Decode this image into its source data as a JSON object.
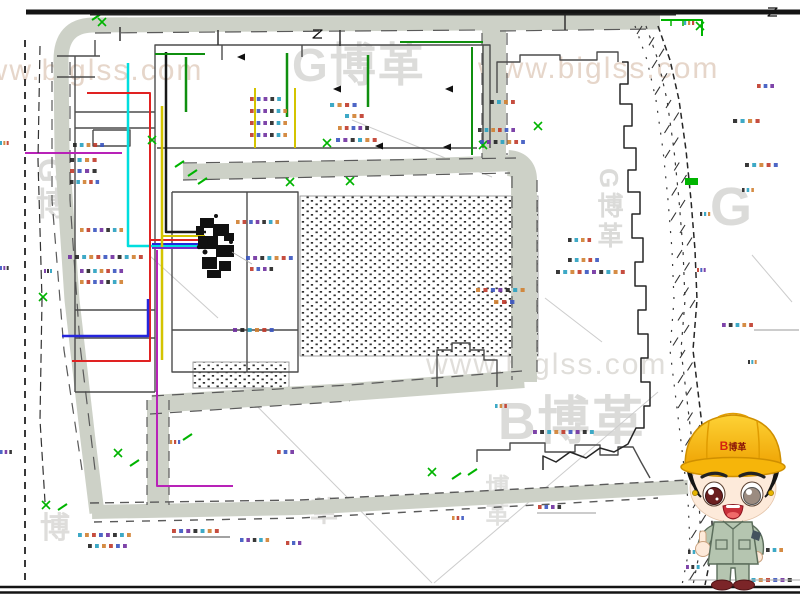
{
  "watermarks": [
    {
      "text": "www.biglss.com",
      "x": -38,
      "y": 56,
      "size": 30,
      "color": "#e6d6ca",
      "bold": false,
      "vertical": false
    },
    {
      "text": "G博革",
      "x": 292,
      "y": 42,
      "size": 46,
      "color": "#dcdcda",
      "bold": true,
      "vertical": false
    },
    {
      "text": "www.biglss.com",
      "x": 478,
      "y": 54,
      "size": 30,
      "color": "#e6d6ca",
      "bold": false,
      "vertical": false
    },
    {
      "text": "G博",
      "x": 34,
      "y": 158,
      "size": 32,
      "color": "#dbdbd9",
      "bold": true,
      "vertical": true
    },
    {
      "text": "G博革",
      "x": 596,
      "y": 168,
      "size": 26,
      "color": "#dbdbd9",
      "bold": true,
      "vertical": true
    },
    {
      "text": "G",
      "x": 710,
      "y": 180,
      "size": 54,
      "color": "#dbdbd9",
      "bold": true,
      "vertical": false
    },
    {
      "text": "www.biglss.com",
      "x": 426,
      "y": 350,
      "size": 30,
      "color": "#e0deda",
      "bold": false,
      "vertical": false
    },
    {
      "text": "B博革",
      "x": 498,
      "y": 396,
      "size": 52,
      "color": "#dbdbd9",
      "bold": true,
      "vertical": false
    },
    {
      "text": "博",
      "x": 40,
      "y": 514,
      "size": 30,
      "color": "#dedddb",
      "bold": true,
      "vertical": false
    },
    {
      "text": "革",
      "x": 310,
      "y": 498,
      "size": 28,
      "color": "#dedddb",
      "bold": true,
      "vertical": false
    },
    {
      "text": "博革",
      "x": 482,
      "y": 474,
      "size": 24,
      "color": "#e0e0de",
      "bold": true,
      "vertical": true
    }
  ],
  "mascot": {
    "hat_logo_b": "B",
    "hat_logo_text": "博革"
  },
  "colors": {
    "road": "#cdd1c7",
    "outline": "#4c4c4c",
    "boundary": "#262626",
    "green": "#00b400",
    "darkgreen": "#0f8f0f",
    "cyan": "#00dede",
    "red": "#e02222",
    "blue": "#2525dd",
    "yellow": "#d4c400",
    "magenta": "#b822b8",
    "purple": "#7828c8",
    "black": "#181818",
    "hatch_dot": "#2f2f2f",
    "annotation_palette": [
      "#3a55c0",
      "#c03a2a",
      "#d08030",
      "#28a0c0",
      "#222222",
      "#7030a0"
    ]
  },
  "diagram": {
    "frame": [
      {
        "d": "M 26,12 L 800,12",
        "w": 5,
        "c": "#141414"
      },
      {
        "d": "M 90,14.5 L 676,14.5",
        "w": 2,
        "c": "#222222"
      },
      {
        "d": "M 0,587 L 800,587",
        "w": 2.4,
        "c": "#141414"
      },
      {
        "d": "M 0,592.5 L 800,592.5",
        "w": 2.4,
        "c": "#141414"
      },
      {
        "d": "M 25,40 L 25,582",
        "w": 1.8,
        "c": "#222222",
        "dash": "7 6"
      },
      {
        "d": "M 40,46 L 38,160 L 42,300 L 40,420 L 45,502",
        "w": 1.2,
        "c": "#333333",
        "dash": "9 5"
      }
    ],
    "roads": [
      {
        "d": "M 97,513 L 88,440 L 72,300 L 62,150 L 61,60 Q 61,26 92,25 L 660,22",
        "w": 15
      },
      {
        "d": "M 92,512 L 300,508 L 500,497 L 688,487",
        "w": 14
      },
      {
        "d": "M 494,29 L 494,160",
        "w": 24
      },
      {
        "d": "M 183,172 L 400,167 L 516,163",
        "w": 16
      },
      {
        "d": "M 508,163 Q 524,164 524,180 L 524,382",
        "w": 26
      },
      {
        "d": "M 152,404 L 350,392 L 524,379",
        "w": 18
      },
      {
        "d": "M 158,400 L 158,506",
        "w": 22
      }
    ],
    "road_edges": [
      {
        "d": "M 95,33 L 480,30",
        "dash": "16 10"
      },
      {
        "d": "M 500,31 L 655,29",
        "dash": "16 10"
      },
      {
        "d": "M 52,62 L 52,200 L 64,350 L 82,470",
        "dash": "11 8"
      },
      {
        "d": "M 70,62 L 70,200 L 80,345 L 96,478",
        "dash": "13 9"
      },
      {
        "d": "M 90,503 L 300,500 L 500,490 L 688,480",
        "dash": "9 6",
        "w": 1.4
      },
      {
        "d": "M 94,522 L 300,518 L 500,507 L 658,498",
        "dash": "8 8",
        "w": 1.4
      },
      {
        "d": "M 183,163 L 516,158",
        "dash": "14 9"
      },
      {
        "d": "M 183,180 L 510,173",
        "dash": "14 9"
      },
      {
        "d": "M 512,176 L 512,380",
        "dash": "12 8"
      },
      {
        "d": "M 537,180 L 537,378",
        "dash": "12 8"
      },
      {
        "d": "M 152,396 L 350,385 L 522,371",
        "dash": "12 8"
      },
      {
        "d": "M 150,414 L 350,401",
        "dash": "12 8"
      },
      {
        "d": "M 482,33 L 482,158",
        "dash": "12 8"
      },
      {
        "d": "M 507,33 L 507,155",
        "dash": "12 8"
      },
      {
        "d": "M 147,400 L 147,505",
        "dash": "10 7"
      },
      {
        "d": "M 169,400 L 169,505",
        "dash": "10 7"
      }
    ],
    "outlines": [
      "M 155,148 L 155,45 L 490,45 L 490,148",
      "M 157,148 L 477,148",
      "M 483,45 L 483,148",
      "M 222,45 L 222,60",
      "M 302,45 L 302,57",
      "M 57,56 L 100,56",
      "M 57,77 L 95,77",
      "M 95,40 L 95,56",
      "M 75,56 L 75,392",
      "M 155,148 L 155,392",
      "M 75,112 L 155,112",
      "M 75,128 L 155,128",
      "M 93,130 L 130,130 L 130,146 L 93,146 L 93,130",
      "M 75,310 L 155,310",
      "M 75,338 L 155,338",
      "M 75,392 L 155,392",
      "M 172,192 L 298,192 L 298,372 L 172,372 L 172,192",
      "M 247,192 L 247,372",
      "M 172,330 L 298,330",
      "M 437,387 L 437,350 L 452,350 L 452,343 L 470,343 L 470,350 L 484,350 L 484,360 L 497,360 L 497,387",
      "M 477,462 L 477,450 L 510,450 L 510,443 L 545,443 L 545,452 L 575,452 L 575,445 L 600,445 L 600,455 L 618,455 L 618,447 L 633,447 L 641,462 L 650,478",
      "M 497,93 L 497,62 L 520,62 L 520,55 L 560,55 L 560,60 L 597,60 L 597,52 L 618,52 L 618,62"
    ],
    "boundary": {
      "solid": [
        "M 622,62 L 628,62 L 628,84 L 620,84 L 620,104 L 632,104 L 632,126 L 624,126 L 624,148 L 636,148 L 636,170 L 628,170 L 628,192 L 640,192 L 640,214 L 632,214 L 632,238 L 643,238 L 643,262 L 635,262 L 635,286 L 646,286 L 646,310 L 638,310 L 638,334 L 648,334 L 648,358 L 641,358 L 641,382 L 650,382 L 650,406 L 644,406 L 644,428 L 636,428 L 628,444 L 614,452 L 600,448 L 586,458 L 570,452 L 556,462 L 543,456 L 543,470"
      ],
      "dashed_pts": [
        [
          658,
          26
        ],
        [
          670,
          60
        ],
        [
          679,
          100
        ],
        [
          686,
          150
        ],
        [
          691,
          200
        ],
        [
          695,
          250
        ],
        [
          697,
          300
        ],
        [
          693,
          350
        ],
        [
          699,
          400
        ],
        [
          705,
          450
        ],
        [
          711,
          500
        ],
        [
          713,
          545
        ],
        [
          705,
          585
        ]
      ],
      "band_offsets": [
        [
          -12,
          "3 7"
        ],
        [
          -23,
          "2 9"
        ]
      ],
      "tick_offsets": [
        -16,
        -8,
        -2,
        -13,
        -6
      ]
    },
    "utilities": [
      {
        "d": "M 128,63 L 128,246 L 205,246",
        "c": "cyan",
        "w": 2.5
      },
      {
        "d": "M 87,93 L 150,93 L 150,361 L 72,361",
        "c": "red",
        "w": 2
      },
      {
        "d": "M 150,240 L 205,240",
        "c": "red",
        "w": 2
      },
      {
        "d": "M 62,336 L 148,336 L 148,299",
        "c": "blue",
        "w": 2.5
      },
      {
        "d": "M 152,244 L 205,244",
        "c": "blue",
        "w": 2
      },
      {
        "d": "M 162,106 L 162,360",
        "c": "yellow",
        "w": 2.5
      },
      {
        "d": "M 162,236 L 205,236",
        "c": "yellow",
        "w": 2
      },
      {
        "d": "M 166,52 L 166,232 L 206,232",
        "c": "black",
        "w": 2.5
      },
      {
        "d": "M 25,153 L 122,153",
        "c": "magenta",
        "w": 2
      },
      {
        "d": "M 157,250 L 157,486 L 233,486",
        "c": "magenta",
        "w": 2
      },
      {
        "d": "M 152,248 L 205,248",
        "c": "purple",
        "w": 2
      },
      {
        "d": "M 186,57 L 186,112",
        "c": "darkgreen",
        "w": 2.5
      },
      {
        "d": "M 287,53 L 287,117",
        "c": "darkgreen",
        "w": 2.5
      },
      {
        "d": "M 368,55 L 368,107",
        "c": "darkgreen",
        "w": 2.5
      },
      {
        "d": "M 472,47 L 472,155",
        "c": "darkgreen",
        "w": 2
      },
      {
        "d": "M 400,42 L 483,42",
        "c": "darkgreen",
        "w": 2
      },
      {
        "d": "M 155,54 L 205,54",
        "c": "darkgreen",
        "w": 2
      },
      {
        "d": "M 255,88 L 255,148",
        "c": "yellow",
        "w": 2
      },
      {
        "d": "M 295,88 L 295,148",
        "c": "yellow",
        "w": 2
      }
    ],
    "hatch_areas": [
      {
        "x": 300,
        "y": 196,
        "w": 238,
        "h": 160
      },
      {
        "x": 193,
        "y": 362,
        "w": 96,
        "h": 26
      }
    ],
    "blob": {
      "rects": [
        [
          200,
          218,
          14,
          10
        ],
        [
          213,
          224,
          16,
          12
        ],
        [
          198,
          236,
          20,
          13
        ],
        [
          216,
          245,
          18,
          12
        ],
        [
          202,
          257,
          15,
          12
        ],
        [
          219,
          261,
          12,
          10
        ],
        [
          207,
          270,
          14,
          8
        ],
        [
          224,
          233,
          10,
          8
        ],
        [
          196,
          226,
          8,
          9
        ]
      ],
      "dots": [
        [
          206,
          222,
          2.5
        ],
        [
          220,
          230,
          3
        ],
        [
          210,
          242,
          3
        ],
        [
          227,
          250,
          2.5
        ],
        [
          205,
          252,
          2.5
        ],
        [
          222,
          266,
          2.5
        ],
        [
          212,
          275,
          2
        ],
        [
          231,
          242,
          2
        ],
        [
          199,
          247,
          2.2
        ],
        [
          216,
          216,
          2
        ]
      ]
    },
    "green_marks": [
      [
        661,
        18,
        "L"
      ],
      [
        700,
        26,
        "x"
      ],
      [
        685,
        178,
        "r"
      ],
      [
        152,
        140,
        "x"
      ],
      [
        327,
        143,
        "x"
      ],
      [
        538,
        126,
        "x"
      ],
      [
        483,
        145,
        "x"
      ],
      [
        175,
        167,
        "d"
      ],
      [
        188,
        176,
        "d"
      ],
      [
        198,
        184,
        "d"
      ],
      [
        350,
        181,
        "x"
      ],
      [
        290,
        182,
        "x"
      ],
      [
        43,
        297,
        "x"
      ],
      [
        46,
        505,
        "x"
      ],
      [
        58,
        510,
        "d"
      ],
      [
        432,
        472,
        "x"
      ],
      [
        452,
        479,
        "d"
      ],
      [
        468,
        475,
        "d"
      ],
      [
        118,
        453,
        "x"
      ],
      [
        130,
        466,
        "d"
      ],
      [
        183,
        440,
        "d"
      ],
      [
        92,
        20,
        "d"
      ],
      [
        102,
        22,
        "x"
      ]
    ],
    "arrows": [
      [
        237,
        57
      ],
      [
        333,
        89
      ],
      [
        445,
        89
      ],
      [
        375,
        146
      ],
      [
        443,
        147
      ]
    ],
    "annotations": [
      [
        73,
        143,
        34
      ],
      [
        70,
        158,
        30
      ],
      [
        70,
        169,
        30
      ],
      [
        70,
        180,
        32
      ],
      [
        80,
        228,
        46
      ],
      [
        68,
        255,
        78
      ],
      [
        80,
        269,
        46
      ],
      [
        80,
        280,
        46
      ],
      [
        44,
        269,
        9
      ],
      [
        250,
        97,
        34
      ],
      [
        250,
        109,
        40
      ],
      [
        250,
        121,
        40
      ],
      [
        250,
        133,
        40
      ],
      [
        330,
        103,
        30
      ],
      [
        345,
        114,
        22
      ],
      [
        338,
        126,
        34
      ],
      [
        336,
        138,
        44
      ],
      [
        478,
        128,
        40
      ],
      [
        480,
        140,
        48
      ],
      [
        490,
        100,
        28
      ],
      [
        236,
        220,
        46
      ],
      [
        246,
        256,
        50
      ],
      [
        250,
        267,
        26
      ],
      [
        476,
        288,
        52
      ],
      [
        494,
        300,
        24
      ],
      [
        233,
        328,
        44
      ],
      [
        533,
        430,
        64
      ],
      [
        495,
        404,
        14
      ],
      [
        757,
        84,
        20
      ],
      [
        733,
        119,
        30
      ],
      [
        745,
        163,
        36
      ],
      [
        742,
        188,
        14
      ],
      [
        700,
        212,
        12
      ],
      [
        568,
        238,
        26
      ],
      [
        568,
        258,
        34
      ],
      [
        556,
        270,
        72
      ],
      [
        697,
        268,
        10
      ],
      [
        722,
        323,
        34
      ],
      [
        748,
        360,
        10
      ],
      [
        740,
        430,
        22
      ],
      [
        700,
        458,
        12
      ],
      [
        742,
        504,
        30
      ],
      [
        688,
        550,
        14
      ],
      [
        686,
        565,
        16
      ],
      [
        766,
        548,
        20
      ],
      [
        737,
        578,
        58
      ],
      [
        684,
        21,
        12
      ],
      [
        78,
        533,
        56
      ],
      [
        88,
        544,
        42
      ],
      [
        172,
        529,
        50
      ],
      [
        240,
        538,
        32
      ],
      [
        286,
        541,
        18
      ],
      [
        452,
        516,
        14
      ],
      [
        538,
        505,
        26
      ],
      [
        0,
        141,
        10
      ],
      [
        0,
        266,
        10
      ],
      [
        0,
        450,
        14
      ],
      [
        170,
        440,
        12
      ],
      [
        277,
        450,
        20
      ]
    ],
    "faint_lines": [
      "M 243,392 L 432,583",
      "M 658,392 L 434,583",
      "M 352,120 L 492,177",
      "M 150,256 L 218,318",
      "M 545,298 L 602,342",
      "M 752,255 L 792,302"
    ],
    "misc": [
      {
        "d": "M 120,27 L 120,41",
        "c": "#333333",
        "w": 1.5
      },
      {
        "d": "M 218,30 L 218,45",
        "c": "#333333",
        "w": 1.5
      },
      {
        "d": "M 340,30 L 340,46",
        "c": "#333333",
        "w": 1.5
      },
      {
        "d": "M 565,14 L 565,30",
        "c": "#333333",
        "w": 1.5
      },
      {
        "d": "M 313,30 L 322,30 L 313,38 L 322,38",
        "c": "#111111",
        "w": 1.3
      },
      {
        "d": "M 768,8 L 777,8 L 768,16 L 777,16",
        "c": "#111111",
        "w": 1.3
      },
      {
        "d": "M 172,537 L 230,537",
        "c": "#444444",
        "w": 1
      },
      {
        "d": "M 537,513 L 596,513",
        "c": "#999999",
        "w": 1
      },
      {
        "d": "M 754,330 L 799,330",
        "c": "#999999",
        "w": 1
      },
      {
        "d": "M 688,580 L 800,580",
        "c": "#aaaaaa",
        "w": 1
      },
      {
        "d": "M 232,252 L 252,264",
        "c": "#b0b0b0",
        "w": 0.8
      }
    ]
  }
}
